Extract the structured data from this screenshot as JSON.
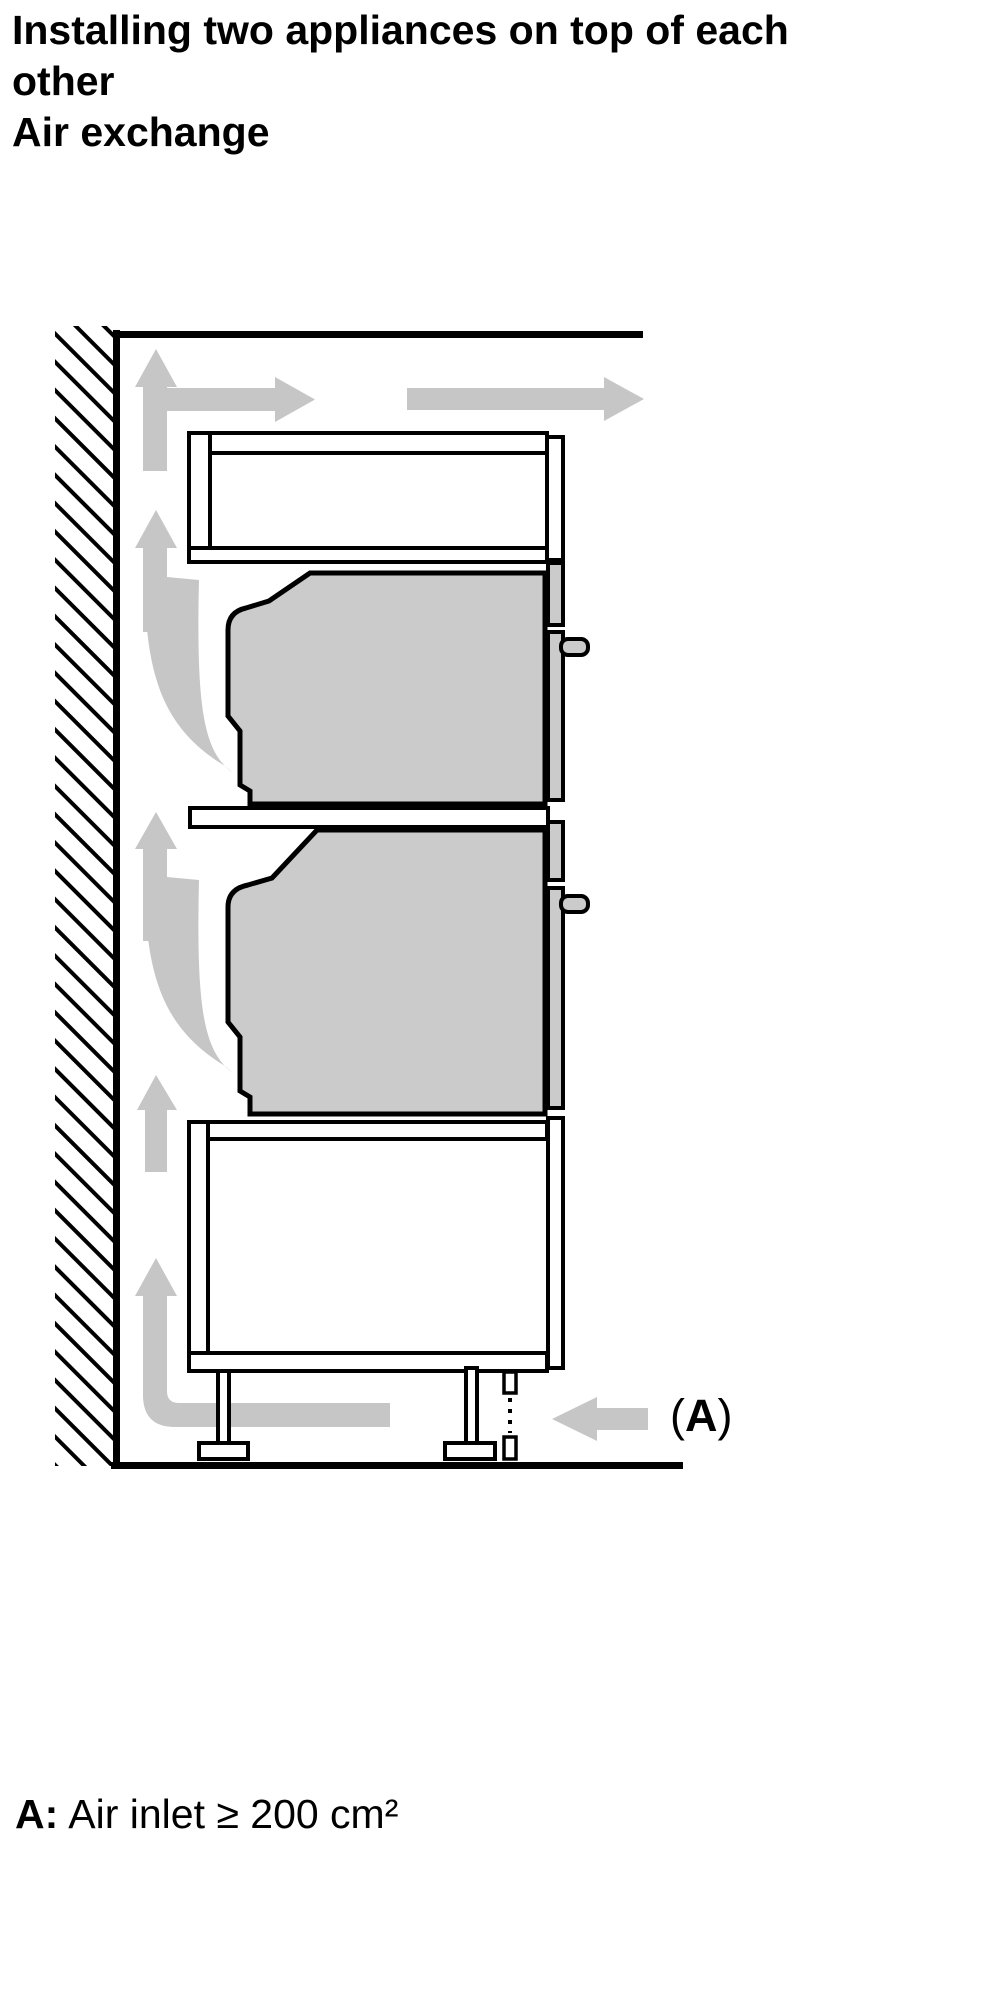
{
  "title": {
    "line1": "Installing two appliances on top of each",
    "line2": "other",
    "line3": "Air exchange"
  },
  "diagram": {
    "inlet_label": {
      "open_paren": "(",
      "letter": "A",
      "close_paren": ")"
    },
    "colors": {
      "arrow_gray": "#c6c6c6",
      "appliance_gray": "#cbcbcb",
      "outline_black": "#000000",
      "background": "#ffffff"
    }
  },
  "caption": {
    "label": "A:",
    "text": "Air inlet ≥ 200 cm²"
  }
}
